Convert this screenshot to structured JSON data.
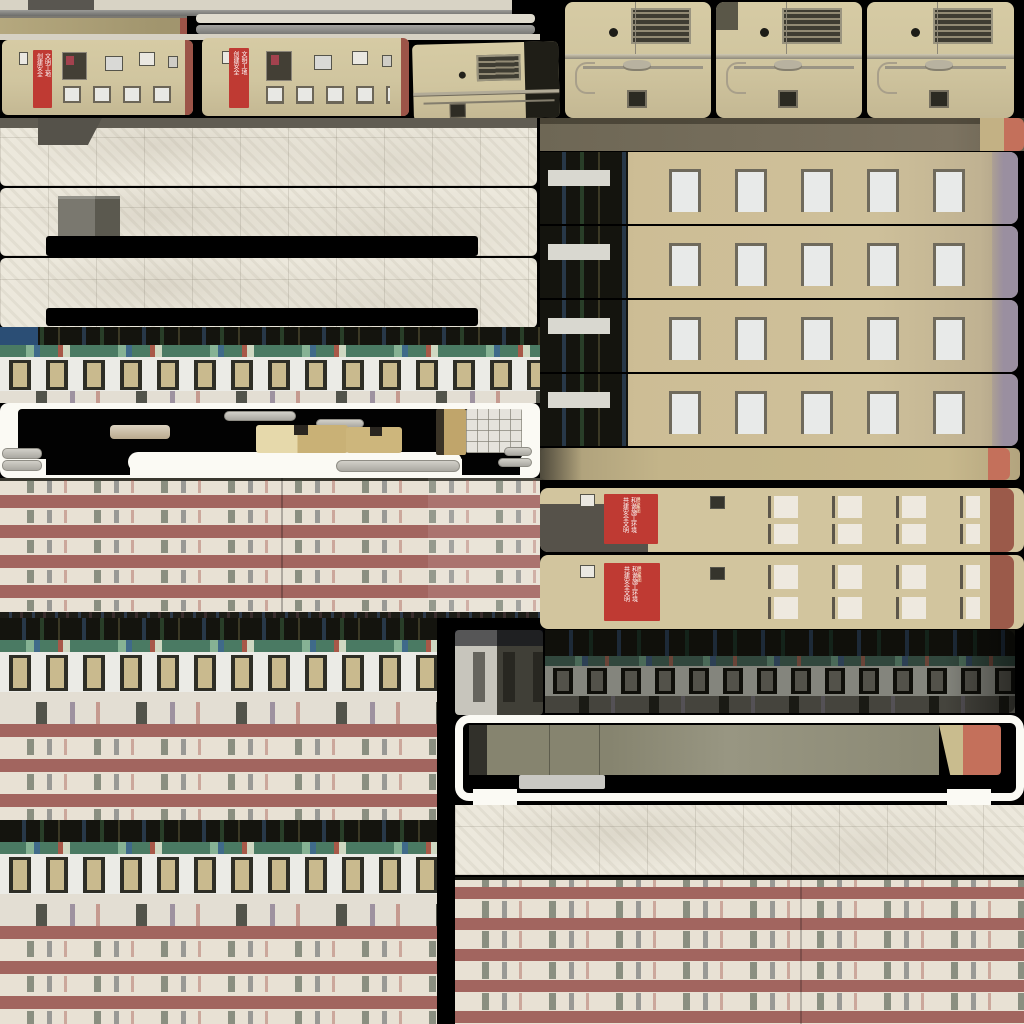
{
  "palette": {
    "bg": "#000000",
    "banner-red": "#bf3a33",
    "band-red": "#a2655f",
    "wall-cream": "#e8e1d4",
    "facade-beige": "#d0c59f",
    "facade-tan": "#cabb92",
    "mauve-edge": "#9a8fa0",
    "salmon": "#c4705b",
    "concrete": "#ece8dc",
    "white-frame": "#fbfaf4",
    "dark-row": "#14140e",
    "teal-banner": "#4a7a63",
    "win-frame": "#2e2e26",
    "win-pane": "#c9ba8e",
    "red-edge": "#9c5448"
  },
  "banners": {
    "pa": {
      "col1": "创建安全",
      "col2": "文明工地"
    },
    "pb": {
      "col1": "创建安全",
      "col2": "文明工地"
    },
    "b1": {
      "col1": "共建安全文明",
      "col2": "和谐施工环境",
      "footer": "建设集团"
    },
    "b2": {
      "col1": "共建安全文明",
      "col2": "和谐施工环境",
      "footer": "建设集团"
    }
  }
}
